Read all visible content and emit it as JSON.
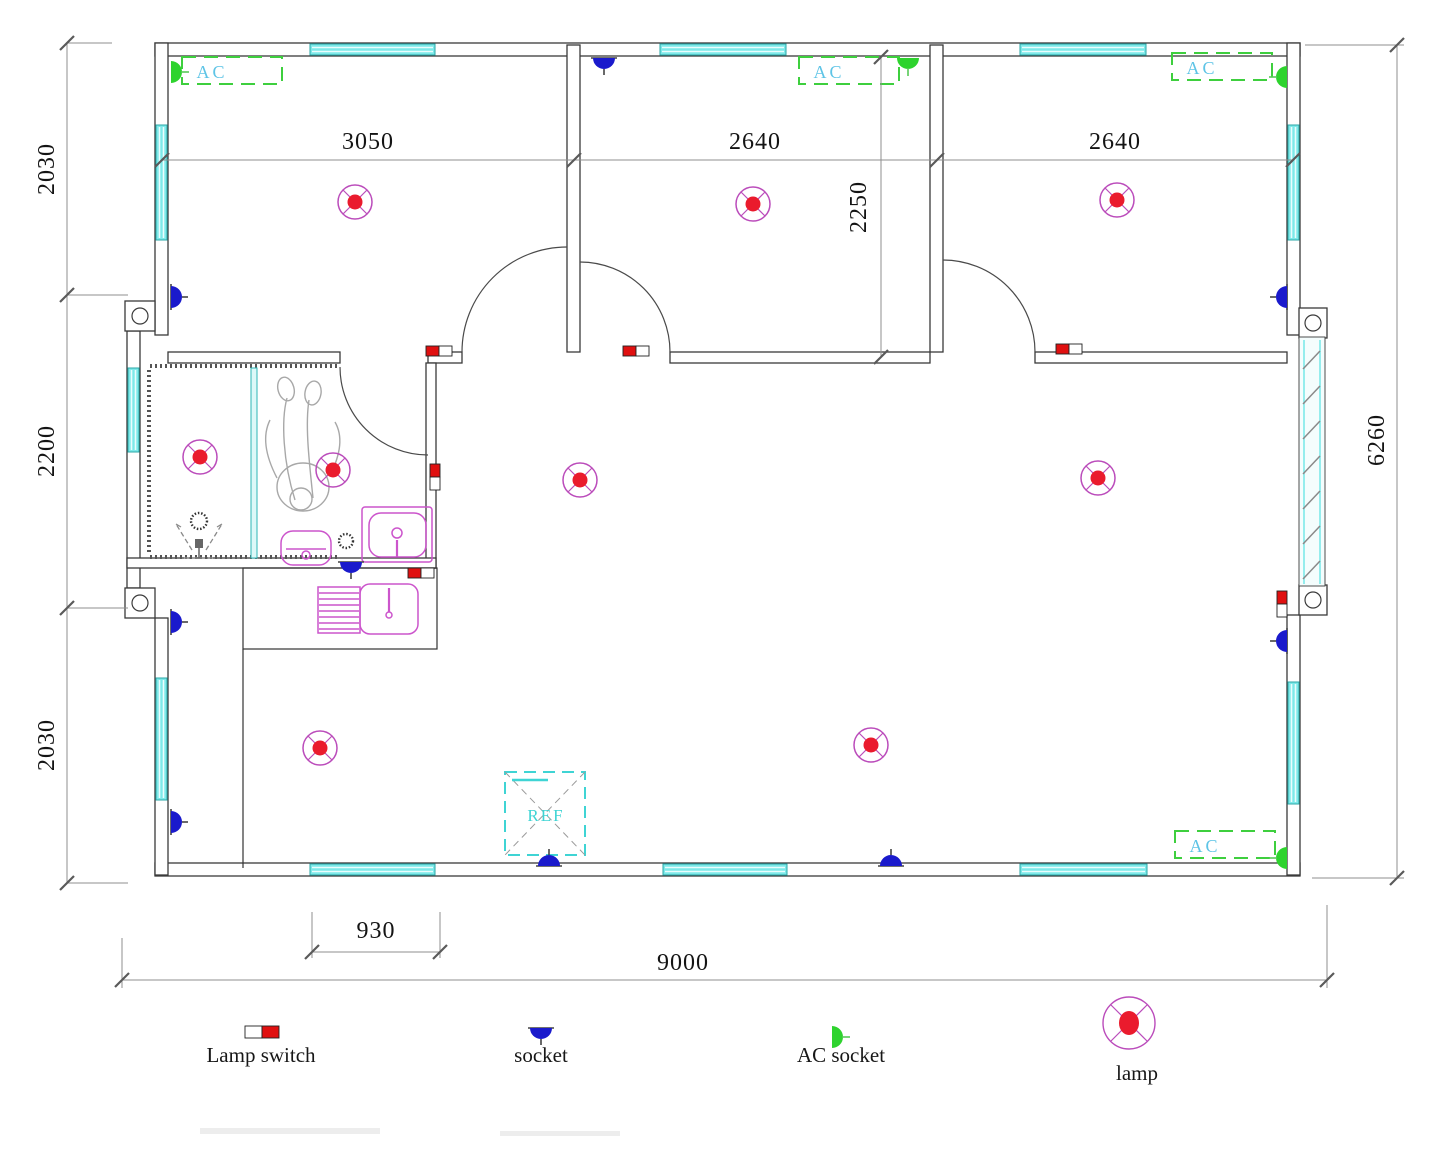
{
  "title": "Electrical floor plan",
  "dimensions": {
    "room1_width": "3050",
    "room2_width": "2640",
    "room3_width": "2640",
    "room2_depth": "2250",
    "left_top": "2030",
    "left_middle": "2200",
    "left_bottom": "2030",
    "right_height": "6260",
    "bottom_small": "930",
    "bottom_total": "9000"
  },
  "labels": {
    "ac_unit": "AC",
    "fridge": "REF"
  },
  "legend": {
    "items": [
      {
        "symbol": "lamp-switch-icon",
        "label": "Lamp switch"
      },
      {
        "symbol": "socket-icon",
        "label": "socket"
      },
      {
        "symbol": "ac-socket-icon",
        "label": "AC socket"
      },
      {
        "symbol": "lamp-icon",
        "label": "lamp"
      }
    ]
  },
  "colors": {
    "wall": "#3a3a3a",
    "window_fill": "#7de9e9",
    "window_border": "#2aa7a7",
    "ac_box_border": "#3ecf3e",
    "ac_label": "#5ec4e6",
    "lamp_ring": "#bb4cbb",
    "lamp_center": "#ea1b2d",
    "socket": "#1a1acc",
    "ac_socket": "#2ed32e",
    "switch_red": "#e01010",
    "fixture": "#cc55cc",
    "ref": "#3fd4d4",
    "dimension_line": "#8f8f8f",
    "dimension_text": "#141414"
  }
}
